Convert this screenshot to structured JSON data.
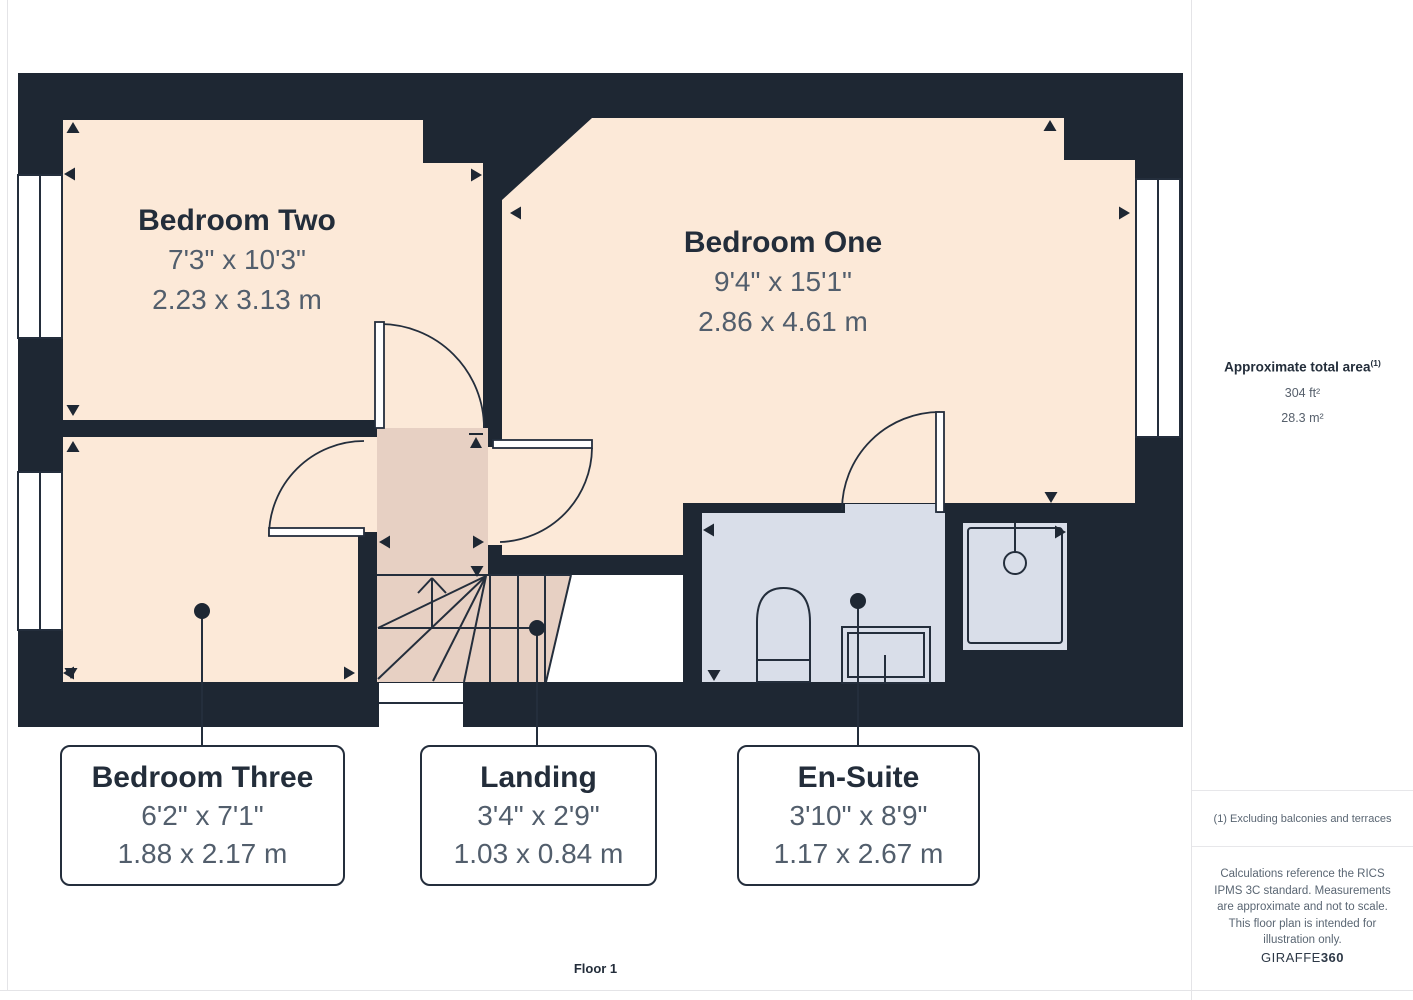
{
  "plan": {
    "floor_label": "Floor 1",
    "rooms": [
      {
        "id": "bedroom-two",
        "name": "Bedroom Two",
        "imperial": "7'3\" x 10'3\"",
        "metric": "2.23 x 3.13 m"
      },
      {
        "id": "bedroom-one",
        "name": "Bedroom One",
        "imperial": "9'4\" x 15'1\"",
        "metric": "2.86 x 4.61 m"
      },
      {
        "id": "bedroom-three",
        "name": "Bedroom Three",
        "imperial": "6'2\" x 7'1\"",
        "metric": "1.88 x 2.17 m"
      },
      {
        "id": "landing",
        "name": "Landing",
        "imperial": "3'4\" x 2'9\"",
        "metric": "1.03 x 0.84 m"
      },
      {
        "id": "en-suite",
        "name": "En-Suite",
        "imperial": "3'10\" x 8'9\"",
        "metric": "1.17 x 2.67 m"
      }
    ],
    "colors": {
      "wall": "#1E2733",
      "room_floor": "#FCE9D8",
      "landing_floor": "#E7D0C3",
      "ensuite_floor": "#D9DEE9",
      "line": "#242E3C",
      "room_title_text": "#232D3A",
      "dimension_text": "#525E6C"
    }
  },
  "sidebar": {
    "area_title": "Approximate total area",
    "area_note_ref": "(1)",
    "area_imperial": "304 ft²",
    "area_metric": "28.3 m²",
    "footnote": "(1) Excluding balconies and terraces",
    "disclaimer": "Calculations reference the RICS IPMS 3C standard. Measurements are approximate and not to scale. This floor plan is intended for illustration only.",
    "brand": {
      "name": "GIRAFFE",
      "suffix": "360"
    }
  }
}
